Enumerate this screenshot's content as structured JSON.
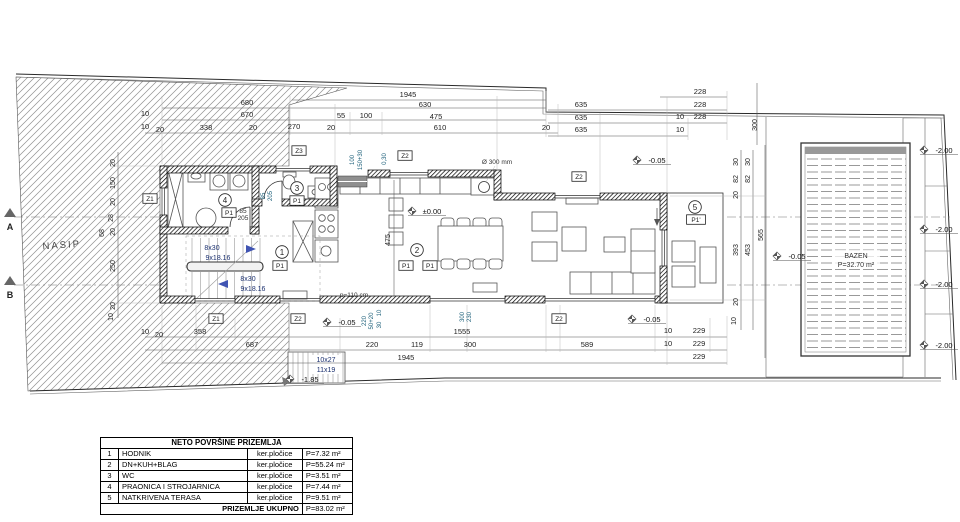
{
  "table": {
    "title": "NETO POVRŠINE PRIZEMLJA",
    "rows": [
      {
        "no": "1",
        "name": "HODNIK",
        "material": "ker.pločice",
        "area": "P=7.32 m²"
      },
      {
        "no": "2",
        "name": "DN+KUH+BLAG",
        "material": "ker.pločice",
        "area": "P=55.24 m²"
      },
      {
        "no": "3",
        "name": "WC",
        "material": "ker.pločice",
        "area": "P=3.51 m²"
      },
      {
        "no": "4",
        "name": "PRAONICA I STROJARNICA",
        "material": "ker.pločice",
        "area": "P=7.44 m²"
      },
      {
        "no": "5",
        "name": "NATKRIVENA TERASA",
        "material": "ker.pločice",
        "area": "P=9.51 m²"
      }
    ],
    "total_label": "PRIZEMLJE UKUPNO",
    "total_area": "P=83.02 m²"
  },
  "plan": {
    "accent_colors": {
      "stair_text": "#1a2f6e",
      "annotation_teal": "#20627c",
      "line": "#2a2a2a"
    },
    "labels": [
      {
        "t": "1945",
        "x": 408,
        "y": 97
      },
      {
        "t": "630",
        "x": 425,
        "y": 107
      },
      {
        "t": "680",
        "x": 247,
        "y": 105
      },
      {
        "t": "670",
        "x": 247,
        "y": 117
      },
      {
        "t": "10",
        "x": 145,
        "y": 116
      },
      {
        "t": "55",
        "x": 341,
        "y": 118
      },
      {
        "t": "100",
        "x": 366,
        "y": 118
      },
      {
        "t": "475",
        "x": 436,
        "y": 119
      },
      {
        "t": "610",
        "x": 440,
        "y": 130
      },
      {
        "t": "270",
        "x": 294,
        "y": 129
      },
      {
        "t": "10",
        "x": 145,
        "y": 129
      },
      {
        "t": "20",
        "x": 160,
        "y": 132
      },
      {
        "t": "338",
        "x": 206,
        "y": 130
      },
      {
        "t": "20",
        "x": 253,
        "y": 130
      },
      {
        "t": "20",
        "x": 331,
        "y": 130
      },
      {
        "t": "20",
        "x": 546,
        "y": 130
      },
      {
        "t": "635",
        "x": 581,
        "y": 107
      },
      {
        "t": "635",
        "x": 581,
        "y": 120
      },
      {
        "t": "635",
        "x": 581,
        "y": 132
      },
      {
        "t": "228",
        "x": 700,
        "y": 94
      },
      {
        "t": "228",
        "x": 700,
        "y": 107
      },
      {
        "t": "228",
        "x": 700,
        "y": 119
      },
      {
        "t": "10",
        "x": 680,
        "y": 119
      },
      {
        "t": "10",
        "x": 680,
        "y": 132
      },
      {
        "t": "300",
        "x": 757,
        "y": 125,
        "k": "dimv"
      },
      {
        "t": "10",
        "x": 145,
        "y": 334
      },
      {
        "t": "20",
        "x": 159,
        "y": 337
      },
      {
        "t": "358",
        "x": 200,
        "y": 334
      },
      {
        "t": "1555",
        "x": 462,
        "y": 334
      },
      {
        "t": "10",
        "x": 668,
        "y": 333
      },
      {
        "t": "229",
        "x": 699,
        "y": 333
      },
      {
        "t": "687",
        "x": 252,
        "y": 347
      },
      {
        "t": "220",
        "x": 372,
        "y": 347
      },
      {
        "t": "119",
        "x": 417,
        "y": 347
      },
      {
        "t": "300",
        "x": 470,
        "y": 347
      },
      {
        "t": "589",
        "x": 587,
        "y": 347
      },
      {
        "t": "10",
        "x": 668,
        "y": 346
      },
      {
        "t": "229",
        "x": 699,
        "y": 346
      },
      {
        "t": "1945",
        "x": 406,
        "y": 360
      },
      {
        "t": "229",
        "x": 699,
        "y": 359
      },
      {
        "t": "220",
        "x": 366,
        "y": 321,
        "k": "dimvs",
        "r": -90
      },
      {
        "t": "50+20",
        "x": 373,
        "y": 321,
        "k": "dimvs",
        "r": -90
      },
      {
        "t": "10",
        "x": 381,
        "y": 313,
        "k": "dimvs",
        "r": -90
      },
      {
        "t": "30",
        "x": 381,
        "y": 325,
        "k": "dimvs",
        "r": -90
      },
      {
        "t": "300",
        "x": 464,
        "y": 317,
        "k": "dimvs",
        "r": -90
      },
      {
        "t": "230",
        "x": 471,
        "y": 317,
        "k": "dimvs",
        "r": -90
      },
      {
        "t": "20",
        "x": 115,
        "y": 163,
        "k": "dimv"
      },
      {
        "t": "150",
        "x": 115,
        "y": 183,
        "k": "dimv"
      },
      {
        "t": "20",
        "x": 115,
        "y": 202,
        "k": "dimv"
      },
      {
        "t": "28",
        "x": 113,
        "y": 218,
        "k": "dimv"
      },
      {
        "t": "20",
        "x": 115,
        "y": 232,
        "k": "dimv"
      },
      {
        "t": "68",
        "x": 104,
        "y": 233,
        "k": "dimv"
      },
      {
        "t": "250",
        "x": 115,
        "y": 266,
        "k": "dimv"
      },
      {
        "t": "20",
        "x": 115,
        "y": 306,
        "k": "dimv"
      },
      {
        "t": "10",
        "x": 113,
        "y": 317,
        "k": "dimv"
      },
      {
        "t": "30",
        "x": 738,
        "y": 162,
        "k": "dimv"
      },
      {
        "t": "82",
        "x": 738,
        "y": 179,
        "k": "dimv"
      },
      {
        "t": "20",
        "x": 738,
        "y": 195,
        "k": "dimv"
      },
      {
        "t": "393",
        "x": 738,
        "y": 250,
        "k": "dimv"
      },
      {
        "t": "20",
        "x": 738,
        "y": 302,
        "k": "dimv"
      },
      {
        "t": "10",
        "x": 736,
        "y": 321,
        "k": "dimv"
      },
      {
        "t": "30",
        "x": 750,
        "y": 162,
        "k": "dimv"
      },
      {
        "t": "82",
        "x": 750,
        "y": 179,
        "k": "dimv"
      },
      {
        "t": "453",
        "x": 750,
        "y": 250,
        "k": "dimv"
      },
      {
        "t": "565",
        "x": 763,
        "y": 235,
        "k": "dimv"
      },
      {
        "t": "475",
        "x": 390,
        "y": 240,
        "k": "dimv"
      },
      {
        "t": "Ø 300 mm",
        "x": 497,
        "y": 164,
        "k": "small"
      },
      {
        "t": "p=110 cm",
        "x": 354,
        "y": 297,
        "k": "small"
      },
      {
        "t": "100",
        "x": 354,
        "y": 160,
        "k": "dimvs",
        "r": -90
      },
      {
        "t": "150+30",
        "x": 362,
        "y": 160,
        "k": "dimvs",
        "r": -90
      },
      {
        "t": "0,30",
        "x": 386,
        "y": 159,
        "k": "dimvs",
        "r": -90
      },
      {
        "t": "85",
        "x": 265,
        "y": 196,
        "k": "dimvs",
        "r": -90
      },
      {
        "t": "205",
        "x": 272,
        "y": 196,
        "k": "dimvs",
        "r": -90
      },
      {
        "t": "85",
        "x": 243,
        "y": 213,
        "k": "small"
      },
      {
        "t": "205",
        "x": 243,
        "y": 220,
        "k": "small"
      },
      {
        "t": "8x30",
        "x": 212,
        "y": 250,
        "k": "stair"
      },
      {
        "t": "9x18.16",
        "x": 218,
        "y": 260,
        "k": "stair"
      },
      {
        "t": "8x30",
        "x": 248,
        "y": 281,
        "k": "stair"
      },
      {
        "t": "9x18.16",
        "x": 253,
        "y": 291,
        "k": "stair"
      },
      {
        "t": "10x27",
        "x": 326,
        "y": 362,
        "k": "stair"
      },
      {
        "t": "11x19",
        "x": 326,
        "y": 372,
        "k": "stair"
      },
      {
        "t": "±0.00",
        "x": 432,
        "y": 214,
        "k": "level"
      },
      {
        "t": "-0.05",
        "x": 657,
        "y": 163,
        "k": "level"
      },
      {
        "t": "-0.05",
        "x": 347,
        "y": 325,
        "k": "level"
      },
      {
        "t": "-0.05",
        "x": 652,
        "y": 322,
        "k": "level"
      },
      {
        "t": "-0.05",
        "x": 797,
        "y": 259,
        "k": "level"
      },
      {
        "t": "-1.85",
        "x": 310,
        "y": 382,
        "k": "level"
      },
      {
        "t": "-2.00",
        "x": 944,
        "y": 153,
        "k": "level"
      },
      {
        "t": "-2.00",
        "x": 944,
        "y": 232,
        "k": "level"
      },
      {
        "t": "-2.00",
        "x": 944,
        "y": 287,
        "k": "level"
      },
      {
        "t": "-2.00",
        "x": 944,
        "y": 348,
        "k": "level"
      },
      {
        "t": "Z1",
        "x": 150,
        "y": 201,
        "k": "zbox"
      },
      {
        "t": "Z3",
        "x": 299,
        "y": 153,
        "k": "zbox"
      },
      {
        "t": "Z2",
        "x": 405,
        "y": 158,
        "k": "zbox"
      },
      {
        "t": "Z2",
        "x": 579,
        "y": 179,
        "k": "zbox"
      },
      {
        "t": "Z1",
        "x": 216,
        "y": 321,
        "k": "zbox"
      },
      {
        "t": "Z2",
        "x": 298,
        "y": 321,
        "k": "zbox"
      },
      {
        "t": "Z2",
        "x": 559,
        "y": 321,
        "k": "zbox"
      },
      {
        "t": "4",
        "x": 225,
        "y": 203,
        "k": "circle"
      },
      {
        "t": "P1",
        "x": 229,
        "y": 215,
        "k": "pbox"
      },
      {
        "t": "3",
        "x": 297,
        "y": 191,
        "k": "circle"
      },
      {
        "t": "P1",
        "x": 297,
        "y": 203,
        "k": "pbox"
      },
      {
        "t": "1",
        "x": 282,
        "y": 255,
        "k": "circle"
      },
      {
        "t": "P1",
        "x": 280,
        "y": 268,
        "k": "pbox"
      },
      {
        "t": "2",
        "x": 417,
        "y": 253,
        "k": "circle"
      },
      {
        "t": "P1",
        "x": 406,
        "y": 268,
        "k": "pbox"
      },
      {
        "t": "P1",
        "x": 430,
        "y": 268,
        "k": "pbox"
      },
      {
        "t": "5",
        "x": 695,
        "y": 210,
        "k": "circle"
      },
      {
        "t": "P1'",
        "x": 696,
        "y": 222,
        "k": "pbox"
      },
      {
        "t": "NASIP",
        "x": 62,
        "y": 248,
        "k": "nasip",
        "r": -4
      },
      {
        "t": "BAZEN",
        "x": 856,
        "y": 258,
        "k": "pool"
      },
      {
        "t": "P=32.70 m²",
        "x": 856,
        "y": 267,
        "k": "pool"
      },
      {
        "t": "A",
        "x": 10,
        "y": 230,
        "k": "section"
      },
      {
        "t": "B",
        "x": 10,
        "y": 298,
        "k": "section"
      }
    ]
  }
}
